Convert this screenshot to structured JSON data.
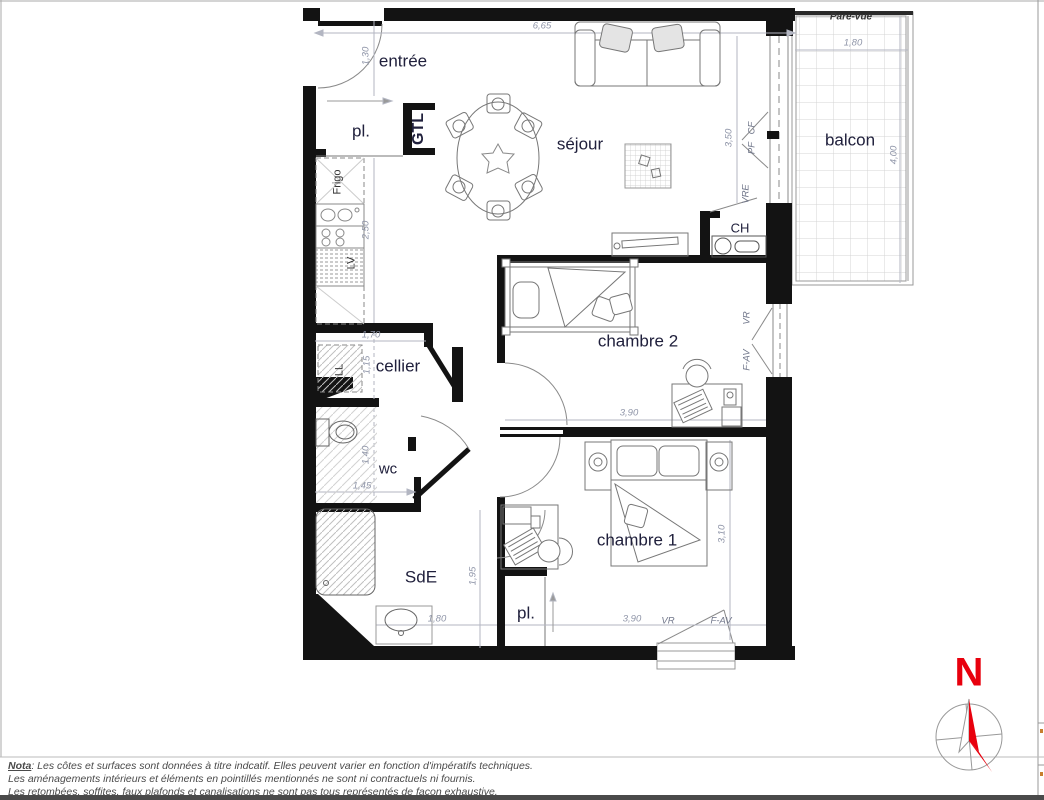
{
  "plan": {
    "rooms": {
      "entree": "entrée",
      "pl_entry": "pl.",
      "gtl": "GTL",
      "sejour": "séjour",
      "balcon": "balcon",
      "ch": "CH",
      "chambre2": "chambre 2",
      "chambre1": "chambre 1",
      "cellier": "cellier",
      "wc": "wc",
      "sde": "SdE",
      "pl_chambre1": "pl."
    },
    "appliances": {
      "frigo": "Frigo",
      "lv": "LV",
      "ll": "LL"
    },
    "openings": {
      "pare_vue": "Pare-vue",
      "cf": "CF",
      "pf": "PF",
      "vre": "VRE",
      "vr_chambre2": "VR",
      "fav_chambre2": "F-AV",
      "vr_chambre1": "VR",
      "fav_chambre1": "F-AV"
    },
    "dimensions": {
      "sejour_width": "6,65",
      "balcon_width": "1,80",
      "entree_door": "1,30",
      "balcon_depth": "4,00",
      "sejour_bay": "3,50",
      "kitchen_run": "2,50",
      "cellier_width": "1,70",
      "cellier_depth": "1,15",
      "wc_depth": "1,40",
      "wc_width": "1,45",
      "sde_depth": "1,95",
      "sde_width": "1,80",
      "chambre2_width": "3,90",
      "chambre1_width": "3,90",
      "chambre1_depth": "3,10"
    },
    "compass": {
      "north": "N",
      "color": "#e8000d"
    }
  },
  "footer": {
    "nota_label": "Nota",
    "nota_line1": ": Les côtes et surfaces sont données à titre indcatif. Elles peuvent varier en fonction d'impératifs techniques.",
    "nota_line2": "Les aménagements intérieurs et éléments en pointillés mentionnés ne sont ni contractuels ni fournis.",
    "nota_line3": "Les retombées, soffites, faux plafonds et canalisations ne sont pas tous représentés de façon exhaustive."
  }
}
